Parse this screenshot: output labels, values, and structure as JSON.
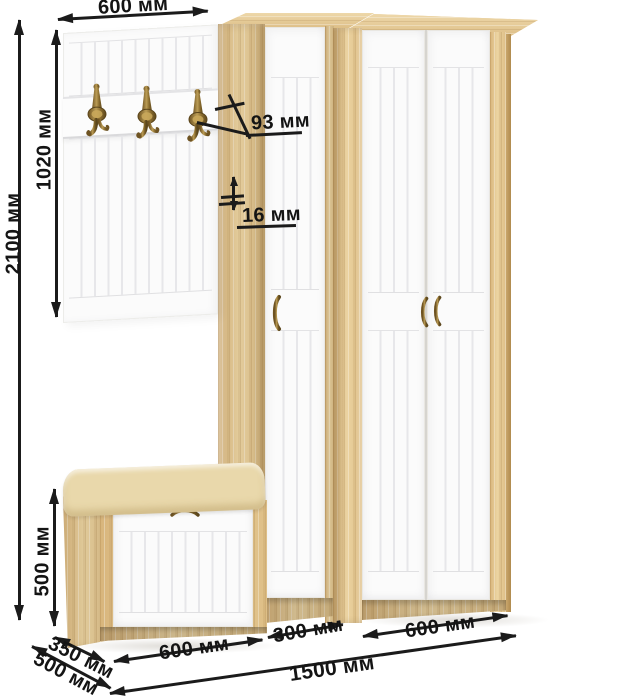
{
  "diagram": {
    "description": "Hallway furniture set dimension drawing",
    "pieces": [
      "coat-hook-panel",
      "narrow-wardrobe",
      "double-door-wardrobe",
      "shoe-bench"
    ],
    "labels": {
      "panel_width": "600 мм",
      "total_height": "2100 мм",
      "panel_height": "1020 мм",
      "hook_projection": "93 мм",
      "panel_thickness": "16 мм",
      "bench_height": "500 мм",
      "bench_depth": "350 мм",
      "total_depth": "500 мм",
      "bench_width": "600 мм",
      "narrow_wardrobe_width": "300 мм",
      "wide_wardrobe_width": "600 мм",
      "total_width": "1500 мм"
    },
    "colors": {
      "dimension_ink": "#1b1b1b",
      "oak": "#e1c28c",
      "door_white": "#fbfbfb",
      "cushion_cream": "#ecdcae",
      "hardware_bronze": "#8a6b2e",
      "background": "#ffffff"
    }
  }
}
